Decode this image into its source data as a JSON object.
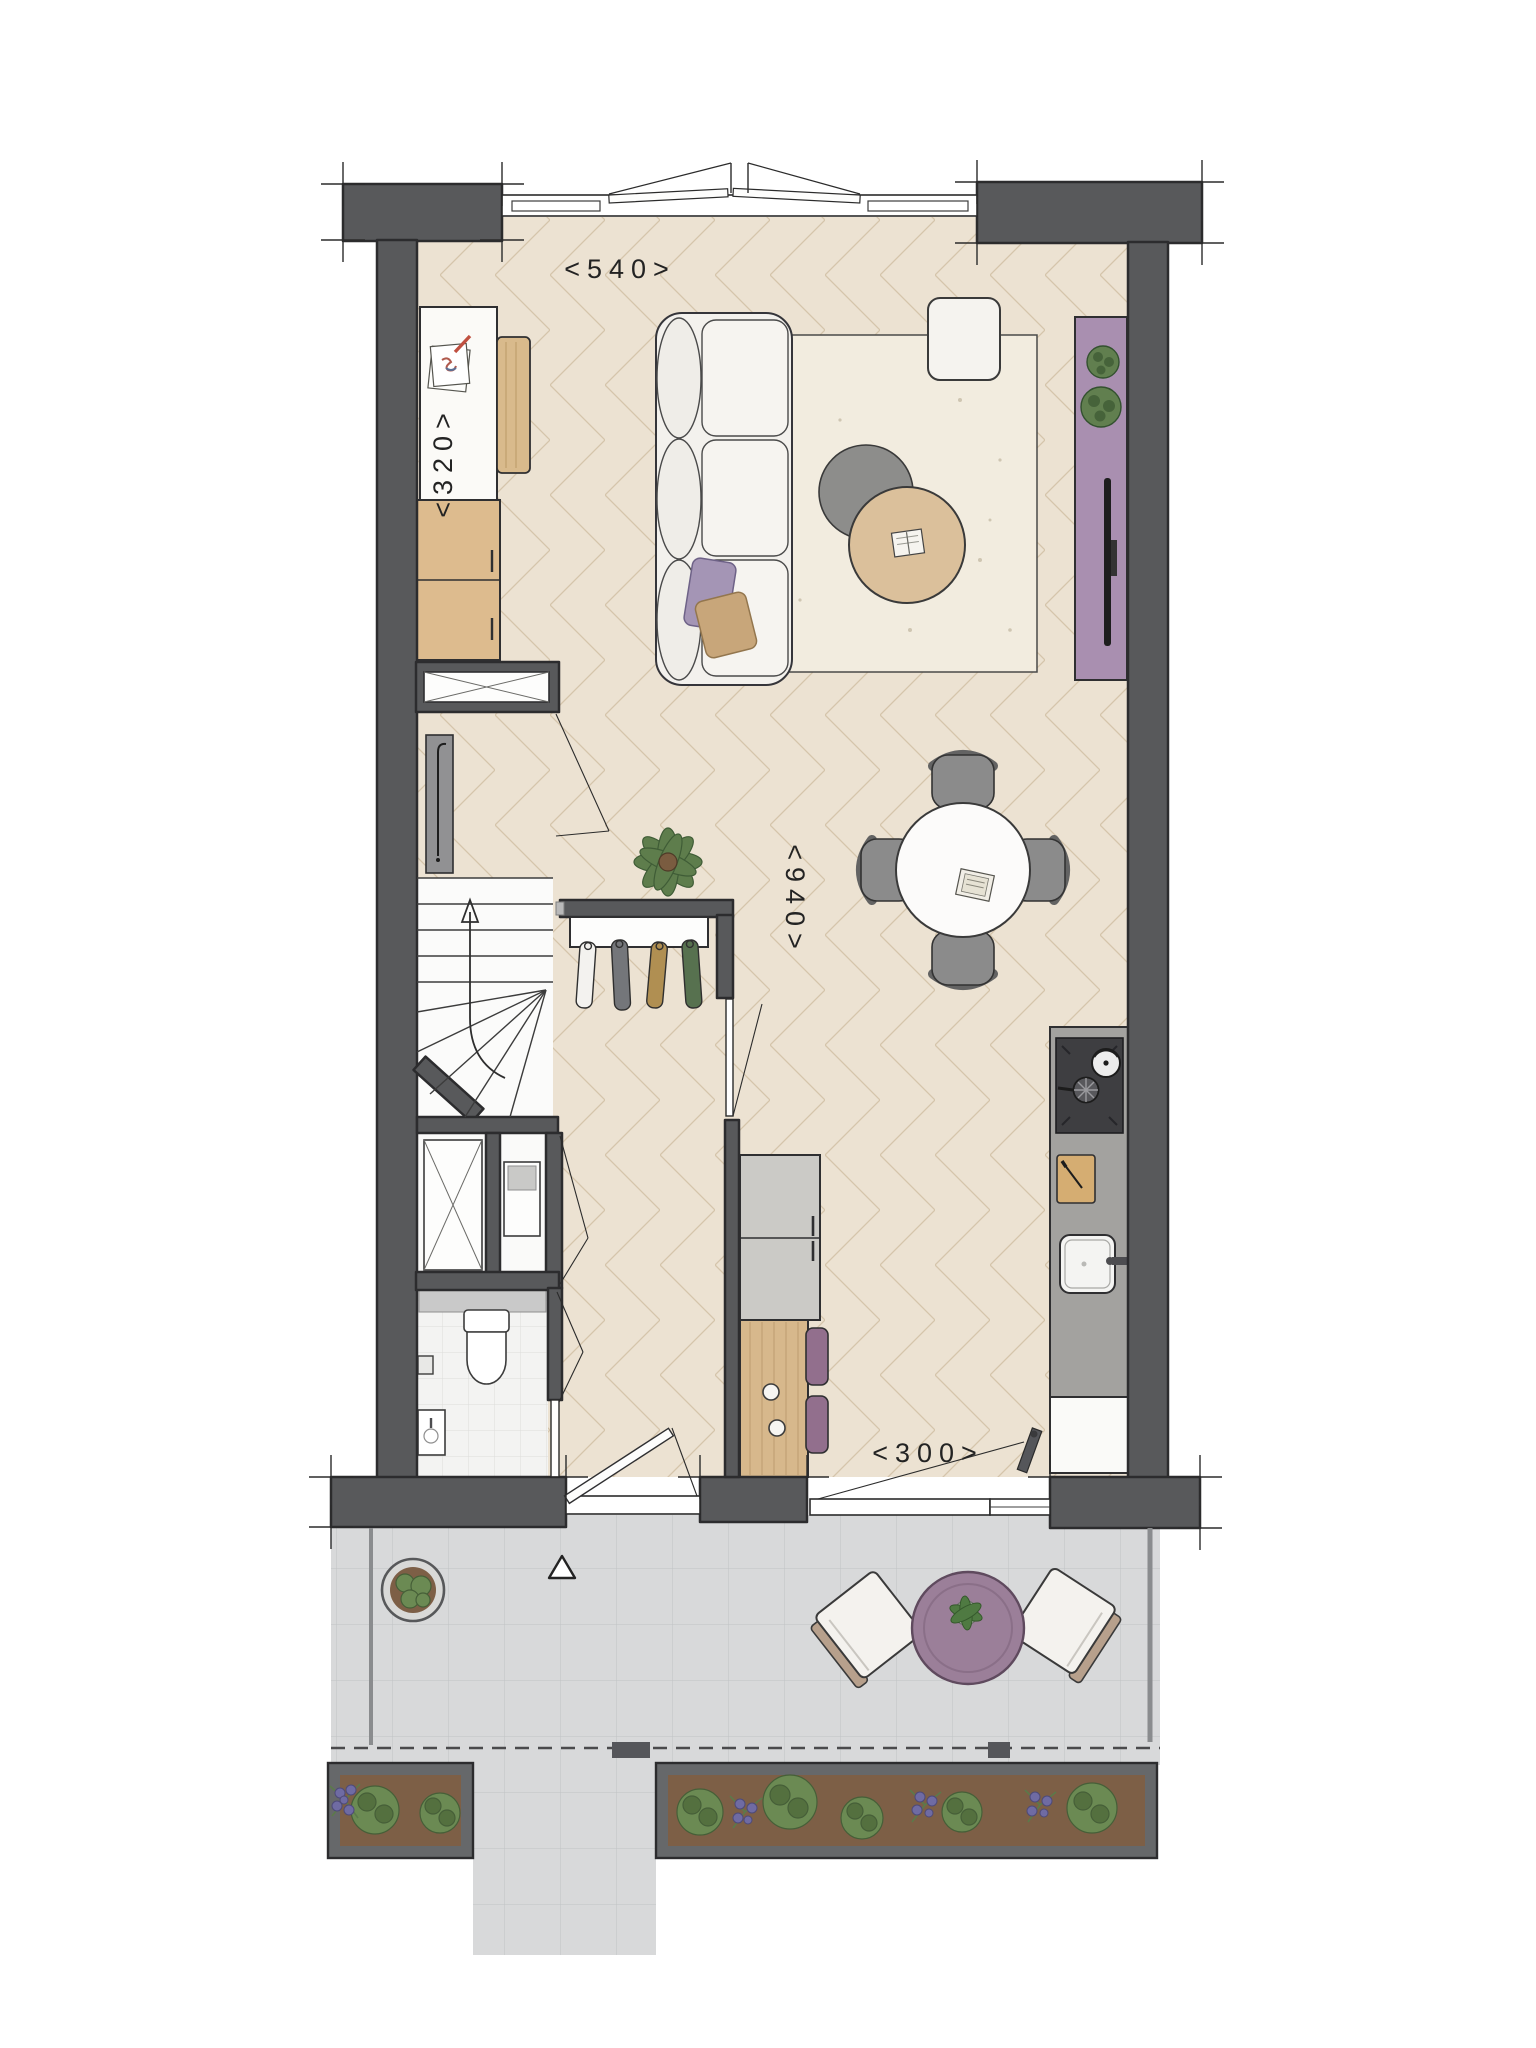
{
  "plan": {
    "type": "floorplan",
    "dimensions": {
      "top": "<540>",
      "left": "<320>",
      "middle": "<940>",
      "bottom": "<300>"
    },
    "colors": {
      "wall": "#58595b",
      "wall_edge": "#2c2c2e",
      "floor_herringbone": "#ece2d2",
      "floor_line": "#d5c5ab",
      "terrace_tile": "#d8d9da",
      "terrace_tile_line": "#c0c2c4",
      "wc_tile": "#f3f3f2",
      "rug": "#f2ecdf",
      "sofa": "#f3f1ed",
      "accent_purple": "#a98fb0",
      "stool_purple": "#926f8d",
      "pillow_purple": "#a495b5",
      "pillow_tan": "#c8a67a",
      "wood": "#d7b88c",
      "wood_table": "#dbc09b",
      "kitchen_counter": "#a3a29f",
      "cooktop": "#3e3e41",
      "appliance_gray": "#cbcac6",
      "chair_gray": "#8b8b8b",
      "plant_green": "#617f4f",
      "plant_dark": "#46633a",
      "soil": "#7d5f46",
      "flower_purple": "#6f6ba3"
    }
  }
}
